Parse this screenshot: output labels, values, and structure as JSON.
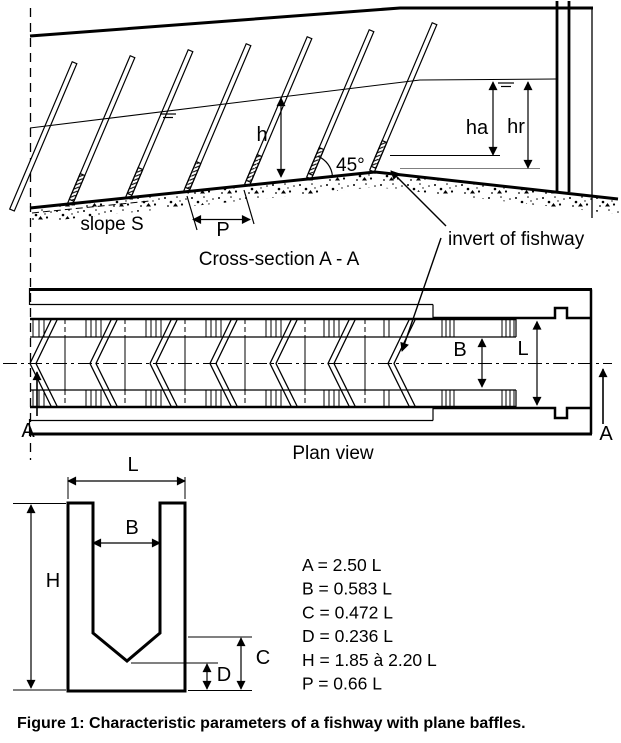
{
  "cross_section": {
    "title": "Cross-section A - A",
    "h_label": "h",
    "ha_label": "ha",
    "hr_label": "hr",
    "angle_label": "45°",
    "slope_label": "slope S",
    "pitch_label": "P",
    "invert_label": "invert of fishway"
  },
  "plan_view": {
    "title": "Plan view",
    "baffle_width_label": "B",
    "channel_width_label": "L",
    "section_marker_left": "A",
    "section_marker_right": "A"
  },
  "baffle_detail": {
    "l_label": "L",
    "b_label": "B",
    "h_label": "H",
    "c_label": "C",
    "d_label": "D",
    "parameters": [
      "A = 2.50 L",
      "B = 0.583 L",
      "C = 0.472 L",
      "D = 0.236 L",
      "H = 1.85 à 2.20 L",
      "P = 0.66 L"
    ]
  },
  "caption": "Figure 1: Characteristic parameters of a fishway with plane baffles.",
  "colors": {
    "ink": "#000000",
    "paper": "#ffffff"
  }
}
